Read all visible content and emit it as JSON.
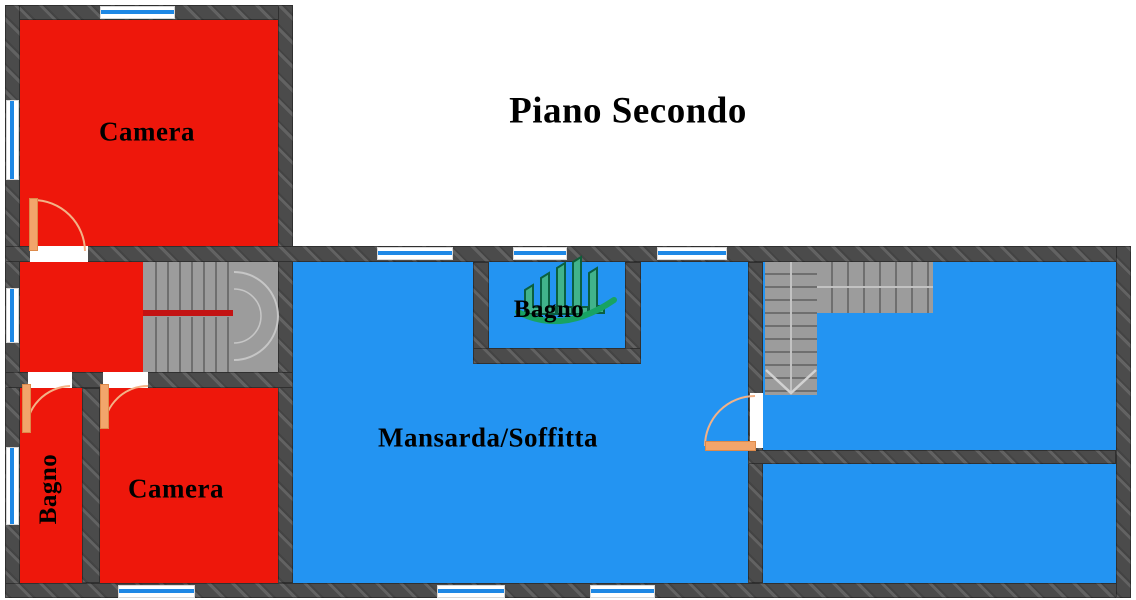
{
  "title": "Piano Secondo",
  "rooms": {
    "camera_top": {
      "label": "Camera"
    },
    "camera_bottom": {
      "label": "Camera"
    },
    "bagno_left": {
      "label": "Bagno"
    },
    "bagno_middle": {
      "label": "Bagno"
    },
    "mansarda": {
      "label": "Mansarda/Soffitta"
    }
  },
  "icons": {
    "logo": "green-bar-chart-swoosh-watermark",
    "stair_direction": "down-arrow",
    "doors": "quarter-circle-door-swing"
  },
  "colors": {
    "room-red": "#ee170b",
    "room-blue": "#2394f2",
    "wall": "#4b4b4b",
    "window-glass": "#1e88e5",
    "door-orange": "#f2a56b",
    "door-edge": "#dd8a4a",
    "door-arc": "#f3b287",
    "stair-fill": "#9c9c9c",
    "stair-tread": "#6f6f6f",
    "handrail-red": "#c31313",
    "logo-green": "#18a45c",
    "logo-dark-green": "#0a5e38",
    "logo-fill": "#43b586",
    "label-color": "#000000"
  }
}
